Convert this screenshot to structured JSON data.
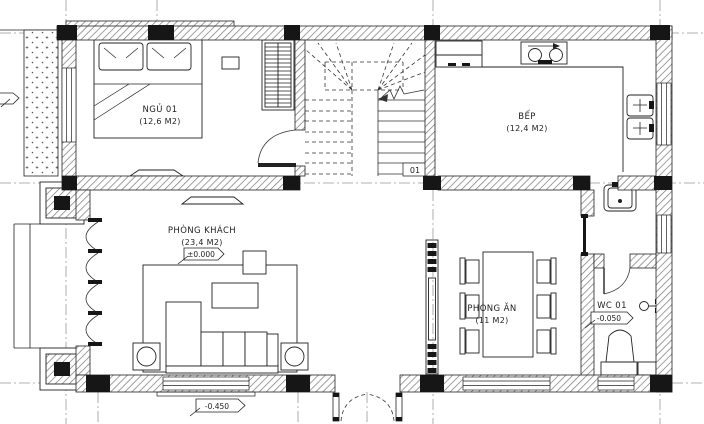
{
  "plan": {
    "bedroom": {
      "label": "NGỦ 01",
      "area": "(12,6 M2)"
    },
    "kitchen": {
      "label": "BẾP",
      "area": "(12,4 M2)"
    },
    "living": {
      "label": "PHÒNG KHÁCH",
      "area": "(23,4 M2)",
      "elevation": "±0.000"
    },
    "dining": {
      "label": "PHÒNG ĂN",
      "area": "(11 M2)"
    },
    "wc": {
      "label": "WC 01",
      "elevation": "-0.050"
    },
    "entry": {
      "elevation": "-0.450"
    },
    "stair": {
      "label": "01"
    },
    "colors": {
      "line": "#222222",
      "hatch": "#777777",
      "grid": "#999999",
      "column": "#161616"
    }
  }
}
